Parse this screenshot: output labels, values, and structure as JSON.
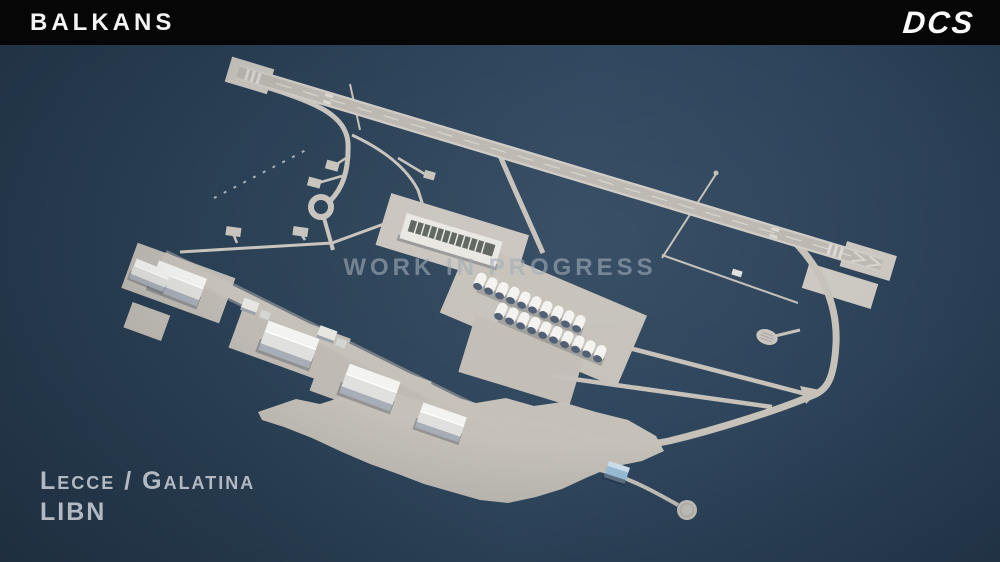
{
  "header": {
    "map_title": "BALKANS",
    "brand_logo": "DCS"
  },
  "watermark": {
    "text": "WORK IN PROGRESS",
    "color": "#9aa5b0"
  },
  "airfield_label": {
    "name": "Lecce / Galatina",
    "icao": "LIBN",
    "color": "#b2b9c2"
  },
  "scene": {
    "subject": "3D aerial render of Lecce / Galatina (LIBN) airbase, work in progress preview",
    "features": [
      "runway",
      "taxiway-network",
      "loop-taxiway",
      "teardrop-turnaround",
      "hangars",
      "aircraft-shelter-rows",
      "aprons",
      "helipad-circle",
      "calibration-pad"
    ],
    "colors": {
      "background": "#2b4156",
      "header_bar": "#060607",
      "header_text": "#f4f4f4",
      "concrete": "#c6c2ba",
      "runway": "#bcb8b1",
      "buildings": "#f3f3f1",
      "shelter_front": "#4e5d72",
      "blue_roof": "#9cc0da"
    }
  }
}
